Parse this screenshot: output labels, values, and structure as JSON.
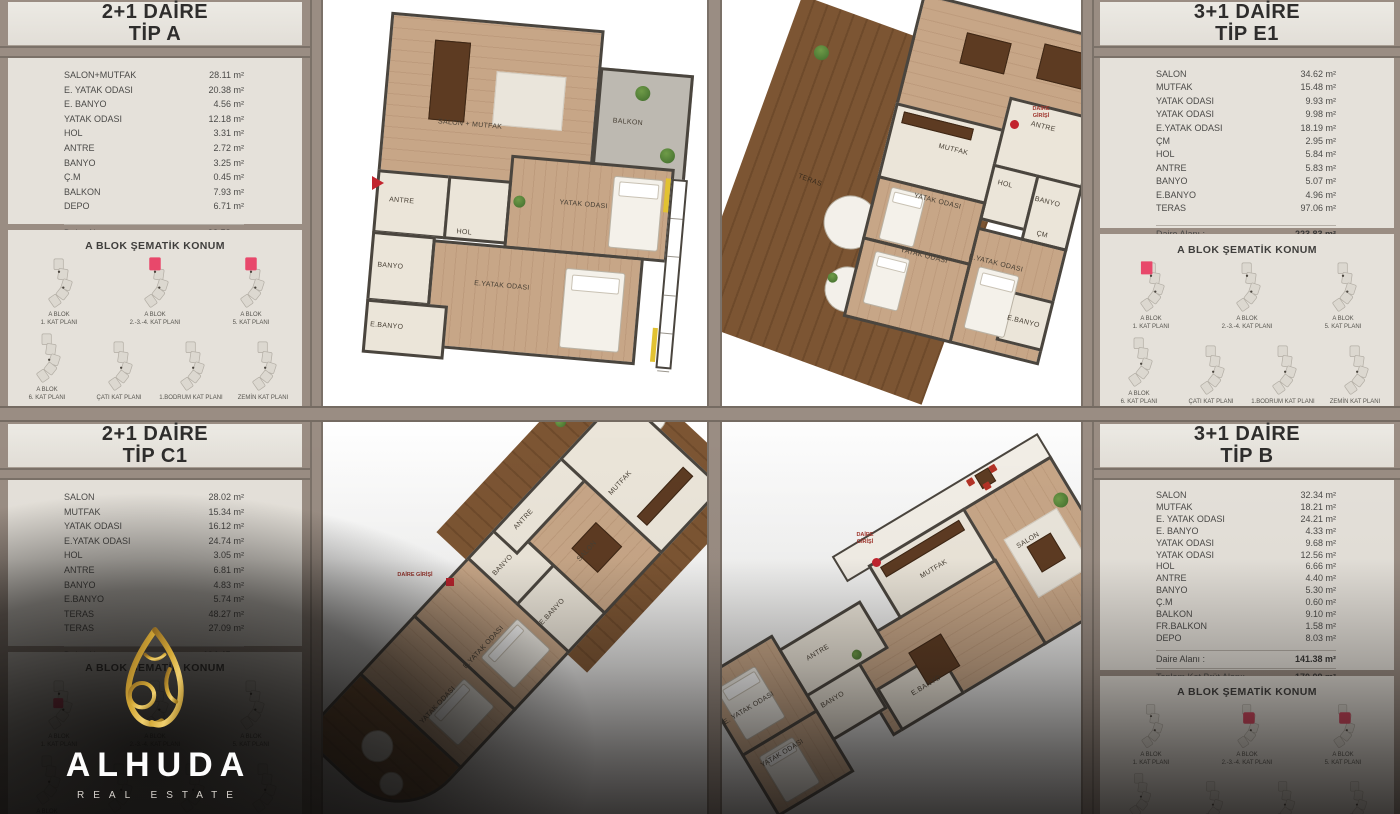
{
  "entry_label": "DAİRE GİRİŞİ",
  "sematik_title": "A BLOK ŞEMATİK KONUM",
  "logo": {
    "name": "ALHUDA",
    "subtitle": "REAL ESTATE"
  },
  "panels": {
    "tip_a": {
      "title_l1": "2+1 DAİRE",
      "title_l2": "TİP A",
      "rooms": [
        {
          "label": "SALON+MUTFAK",
          "value": "28.11 m²"
        },
        {
          "label": "E. YATAK ODASI",
          "value": "20.38 m²"
        },
        {
          "label": "E. BANYO",
          "value": "4.56 m²"
        },
        {
          "label": "YATAK ODASI",
          "value": "12.18 m²"
        },
        {
          "label": "HOL",
          "value": "3.31 m²"
        },
        {
          "label": "ANTRE",
          "value": "2.72 m²"
        },
        {
          "label": "BANYO",
          "value": "3.25 m²"
        },
        {
          "label": "Ç.M",
          "value": "0.45 m²"
        },
        {
          "label": "BALKON",
          "value": "7.93 m²"
        },
        {
          "label": "DEPO",
          "value": "6.71 m²"
        }
      ],
      "daire_label": "Daire  Alanı :",
      "daire": "92.58 m²",
      "brut_label": "Toplam Kat Brüt Alanı:",
      "brut": "113.04 m²",
      "brut_note": "(Ortak Mekanlar Dahil)",
      "sem_row1": [
        {
          "l1": "A BLOK",
          "l2": "1. KAT PLANI",
          "hl": false
        },
        {
          "l1": "A BLOK",
          "l2": "2.-3.-4. KAT PLANI",
          "hl": true
        },
        {
          "l1": "A BLOK",
          "l2": "5. KAT PLANI",
          "hl": true
        }
      ],
      "sem_row2": [
        {
          "l1": "A BLOK",
          "l2": "6. KAT PLANI",
          "hl": false
        },
        {
          "l1": "",
          "l2": "ÇATI KAT PLANI",
          "hl": false
        },
        {
          "l1": "",
          "l2": "1.BODRUM KAT PLANI",
          "hl": false
        },
        {
          "l1": "",
          "l2": "ZEMİN KAT PLANI",
          "hl": false
        }
      ]
    },
    "tip_e1": {
      "title_l1": "3+1 DAİRE",
      "title_l2": "TİP E1",
      "rooms": [
        {
          "label": "SALON",
          "value": "34.62 m²"
        },
        {
          "label": "MUTFAK",
          "value": "15.48 m²"
        },
        {
          "label": "YATAK ODASI",
          "value": "9.93 m²"
        },
        {
          "label": "YATAK ODASI",
          "value": "9.98 m²"
        },
        {
          "label": "E.YATAK ODASI",
          "value": "18.19 m²"
        },
        {
          "label": "ÇM",
          "value": "2.95 m²"
        },
        {
          "label": "HOL",
          "value": "5.84 m²"
        },
        {
          "label": "ANTRE",
          "value": "5.83 m²"
        },
        {
          "label": "BANYO",
          "value": "5.07 m²"
        },
        {
          "label": "E.BANYO",
          "value": "4.96 m²"
        },
        {
          "label": "TERAS",
          "value": "97.06 m²"
        }
      ],
      "daire_label": "Daire Alanı :",
      "daire": "223.83 m²",
      "brut_label": "Toplam Kat Brüt Alanı:",
      "brut": "254.82 m²",
      "brut_note": "(Ortak Mekanlar Dahil)",
      "sem_row1": [
        {
          "l1": "A BLOK",
          "l2": "1. KAT PLANI",
          "hl": true
        },
        {
          "l1": "A BLOK",
          "l2": "2.-3.-4. KAT PLANI",
          "hl": false
        },
        {
          "l1": "A BLOK",
          "l2": "5. KAT PLANI",
          "hl": false
        }
      ],
      "sem_row2": [
        {
          "l1": "A BLOK",
          "l2": "6. KAT PLANI",
          "hl": false
        },
        {
          "l1": "",
          "l2": "ÇATI KAT PLANI",
          "hl": false
        },
        {
          "l1": "",
          "l2": "1.BODRUM KAT PLANI",
          "hl": false
        },
        {
          "l1": "",
          "l2": "ZEMİN KAT PLANI",
          "hl": false
        }
      ]
    },
    "tip_c1": {
      "title_l1": "2+1 DAİRE",
      "title_l2": "TİP C1",
      "rooms": [
        {
          "label": "SALON",
          "value": "28.02 m²"
        },
        {
          "label": "MUTFAK",
          "value": "15.34 m²"
        },
        {
          "label": "YATAK ODASI",
          "value": "16.12 m²"
        },
        {
          "label": "E.YATAK ODASI",
          "value": "24.74 m²"
        },
        {
          "label": "HOL",
          "value": "3.05 m²"
        },
        {
          "label": "ANTRE",
          "value": "6.81 m²"
        },
        {
          "label": "BANYO",
          "value": "4.83 m²"
        },
        {
          "label": "E.BANYO",
          "value": "5.74 m²"
        },
        {
          "label": "TERAS",
          "value": "48.27 m²"
        },
        {
          "label": "TERAS",
          "value": "27.09 m²"
        }
      ],
      "daire_label": "Daire  Alanı :",
      "daire": "194.45 m²",
      "brut_label": "Toplam Kat Brüt Alanı:",
      "brut": "221.38 m²",
      "brut_note": "(Ortak Mekanlar Dahil)",
      "sem_row1": [
        {
          "l1": "A BLOK",
          "l2": "1. KAT PLANI",
          "hl": true
        },
        {
          "l1": "A BLOK",
          "l2": "2.-3.-4. KAT PLANI",
          "hl": false
        },
        {
          "l1": "A BLOK",
          "l2": "5. KAT PLANI",
          "hl": false
        }
      ],
      "sem_row2": [
        {
          "l1": "A BLOK",
          "l2": "6. KAT PLANI",
          "hl": false
        },
        {
          "l1": "",
          "l2": "ÇATI KAT PLANI",
          "hl": false
        },
        {
          "l1": "",
          "l2": "1.BODRUM KAT PLANI",
          "hl": false
        },
        {
          "l1": "",
          "l2": "ZEMİN KAT PLANI",
          "hl": false
        }
      ]
    },
    "tip_b": {
      "title_l1": "3+1 DAİRE",
      "title_l2": "TİP B",
      "rooms": [
        {
          "label": "SALON",
          "value": "32.34 m²"
        },
        {
          "label": "MUTFAK",
          "value": "18.21 m²"
        },
        {
          "label": "E. YATAK ODASI",
          "value": "24.21 m²"
        },
        {
          "label": "E. BANYO",
          "value": "4.33 m²"
        },
        {
          "label": "YATAK ODASI",
          "value": "9.68 m²"
        },
        {
          "label": "YATAK ODASI",
          "value": "12.56 m²"
        },
        {
          "label": "HOL",
          "value": "6.66 m²"
        },
        {
          "label": "ANTRE",
          "value": "4.40 m²"
        },
        {
          "label": "BANYO",
          "value": "5.30 m²"
        },
        {
          "label": "Ç.M",
          "value": "0.60 m²"
        },
        {
          "label": "BALKON",
          "value": "9.10 m²"
        },
        {
          "label": "FR.BALKON",
          "value": "1.58 m²"
        },
        {
          "label": "DEPO",
          "value": "8.03 m²"
        }
      ],
      "daire_label": "Daire Alanı :",
      "daire": "141.38 m²",
      "brut_label": "Toplam Kat Brüt Alanı:",
      "brut": "170.09 m²",
      "brut_note": "(Ortak Mekanlar Dahil)",
      "sem_row1": [
        {
          "l1": "A BLOK",
          "l2": "1. KAT PLANI",
          "hl": false
        },
        {
          "l1": "A BLOK",
          "l2": "2.-3.-4. KAT PLANI",
          "hl": true
        },
        {
          "l1": "A BLOK",
          "l2": "5. KAT PLANI",
          "hl": true
        }
      ],
      "sem_row2": [
        {
          "l1": "A BLOK",
          "l2": "6. KAT PLANI",
          "hl": false
        },
        {
          "l1": "",
          "l2": "ÇATI KAT PLANI",
          "hl": false
        },
        {
          "l1": "",
          "l2": "1.BODRUM KAT PLANI",
          "hl": false
        },
        {
          "l1": "",
          "l2": "ZEMİN KAT PLANI",
          "hl": false
        }
      ]
    }
  },
  "plans": {
    "tip_a": {
      "labels": [
        {
          "t": "SALON + MUTFAK",
          "x": 68,
          "y": 110
        },
        {
          "t": "BALKON",
          "x": 242,
          "y": 94
        },
        {
          "t": "ANTRE",
          "x": 26,
          "y": 192
        },
        {
          "t": "HOL",
          "x": 96,
          "y": 218
        },
        {
          "t": "BANYO",
          "x": 20,
          "y": 258
        },
        {
          "t": "YATAK ODASI",
          "x": 196,
          "y": 180
        },
        {
          "t": "E.YATAK ODASI",
          "x": 118,
          "y": 268
        },
        {
          "t": "E.BANYO",
          "x": 18,
          "y": 318
        }
      ]
    },
    "tip_e1": {
      "teras_label": {
        "t": "TERAS",
        "x": 58,
        "y": 168
      },
      "labels": [
        {
          "t": "MUTFAK",
          "x": 52,
          "y": 142
        },
        {
          "t": "ANTRE",
          "x": 136,
          "y": 98
        },
        {
          "t": "HOL",
          "x": 118,
          "y": 163
        },
        {
          "t": "BANYO",
          "x": 158,
          "y": 170
        },
        {
          "t": "YATAK ODASI",
          "x": 40,
          "y": 196
        },
        {
          "t": "YATAK ODASI",
          "x": 40,
          "y": 252
        },
        {
          "t": "ÇM",
          "x": 168,
          "y": 203
        },
        {
          "t": "E.YATAK ODASI",
          "x": 108,
          "y": 242
        },
        {
          "t": "E.BANYO",
          "x": 160,
          "y": 292
        }
      ]
    },
    "tip_c1": {
      "labels": [
        {
          "t": "MUTFAK",
          "x": 388,
          "y": 58
        },
        {
          "t": "ANTRE",
          "x": 298,
          "y": 12
        },
        {
          "t": "SALON",
          "x": 318,
          "y": 80
        },
        {
          "t": "BANYO",
          "x": 250,
          "y": 28
        },
        {
          "t": "E.BANYO",
          "x": 246,
          "y": 96
        },
        {
          "t": "E.YATAK ODASI",
          "x": 162,
          "y": 70
        },
        {
          "t": "YATAK ODASI",
          "x": 92,
          "y": 76
        }
      ]
    },
    "tip_b": {
      "labels": [
        {
          "t": "MUTFAK",
          "x": 246,
          "y": 34
        },
        {
          "t": "SALON",
          "x": 344,
          "y": 58
        },
        {
          "t": "ANTRE",
          "x": 106,
          "y": 46
        },
        {
          "t": "BANYO",
          "x": 94,
          "y": 94
        },
        {
          "t": "E.BANYO",
          "x": 178,
          "y": 130
        },
        {
          "t": "YATAK ODASI",
          "x": 12,
          "y": 114
        },
        {
          "t": "E. YATAK ODASI",
          "x": 2,
          "y": 58
        }
      ]
    }
  }
}
